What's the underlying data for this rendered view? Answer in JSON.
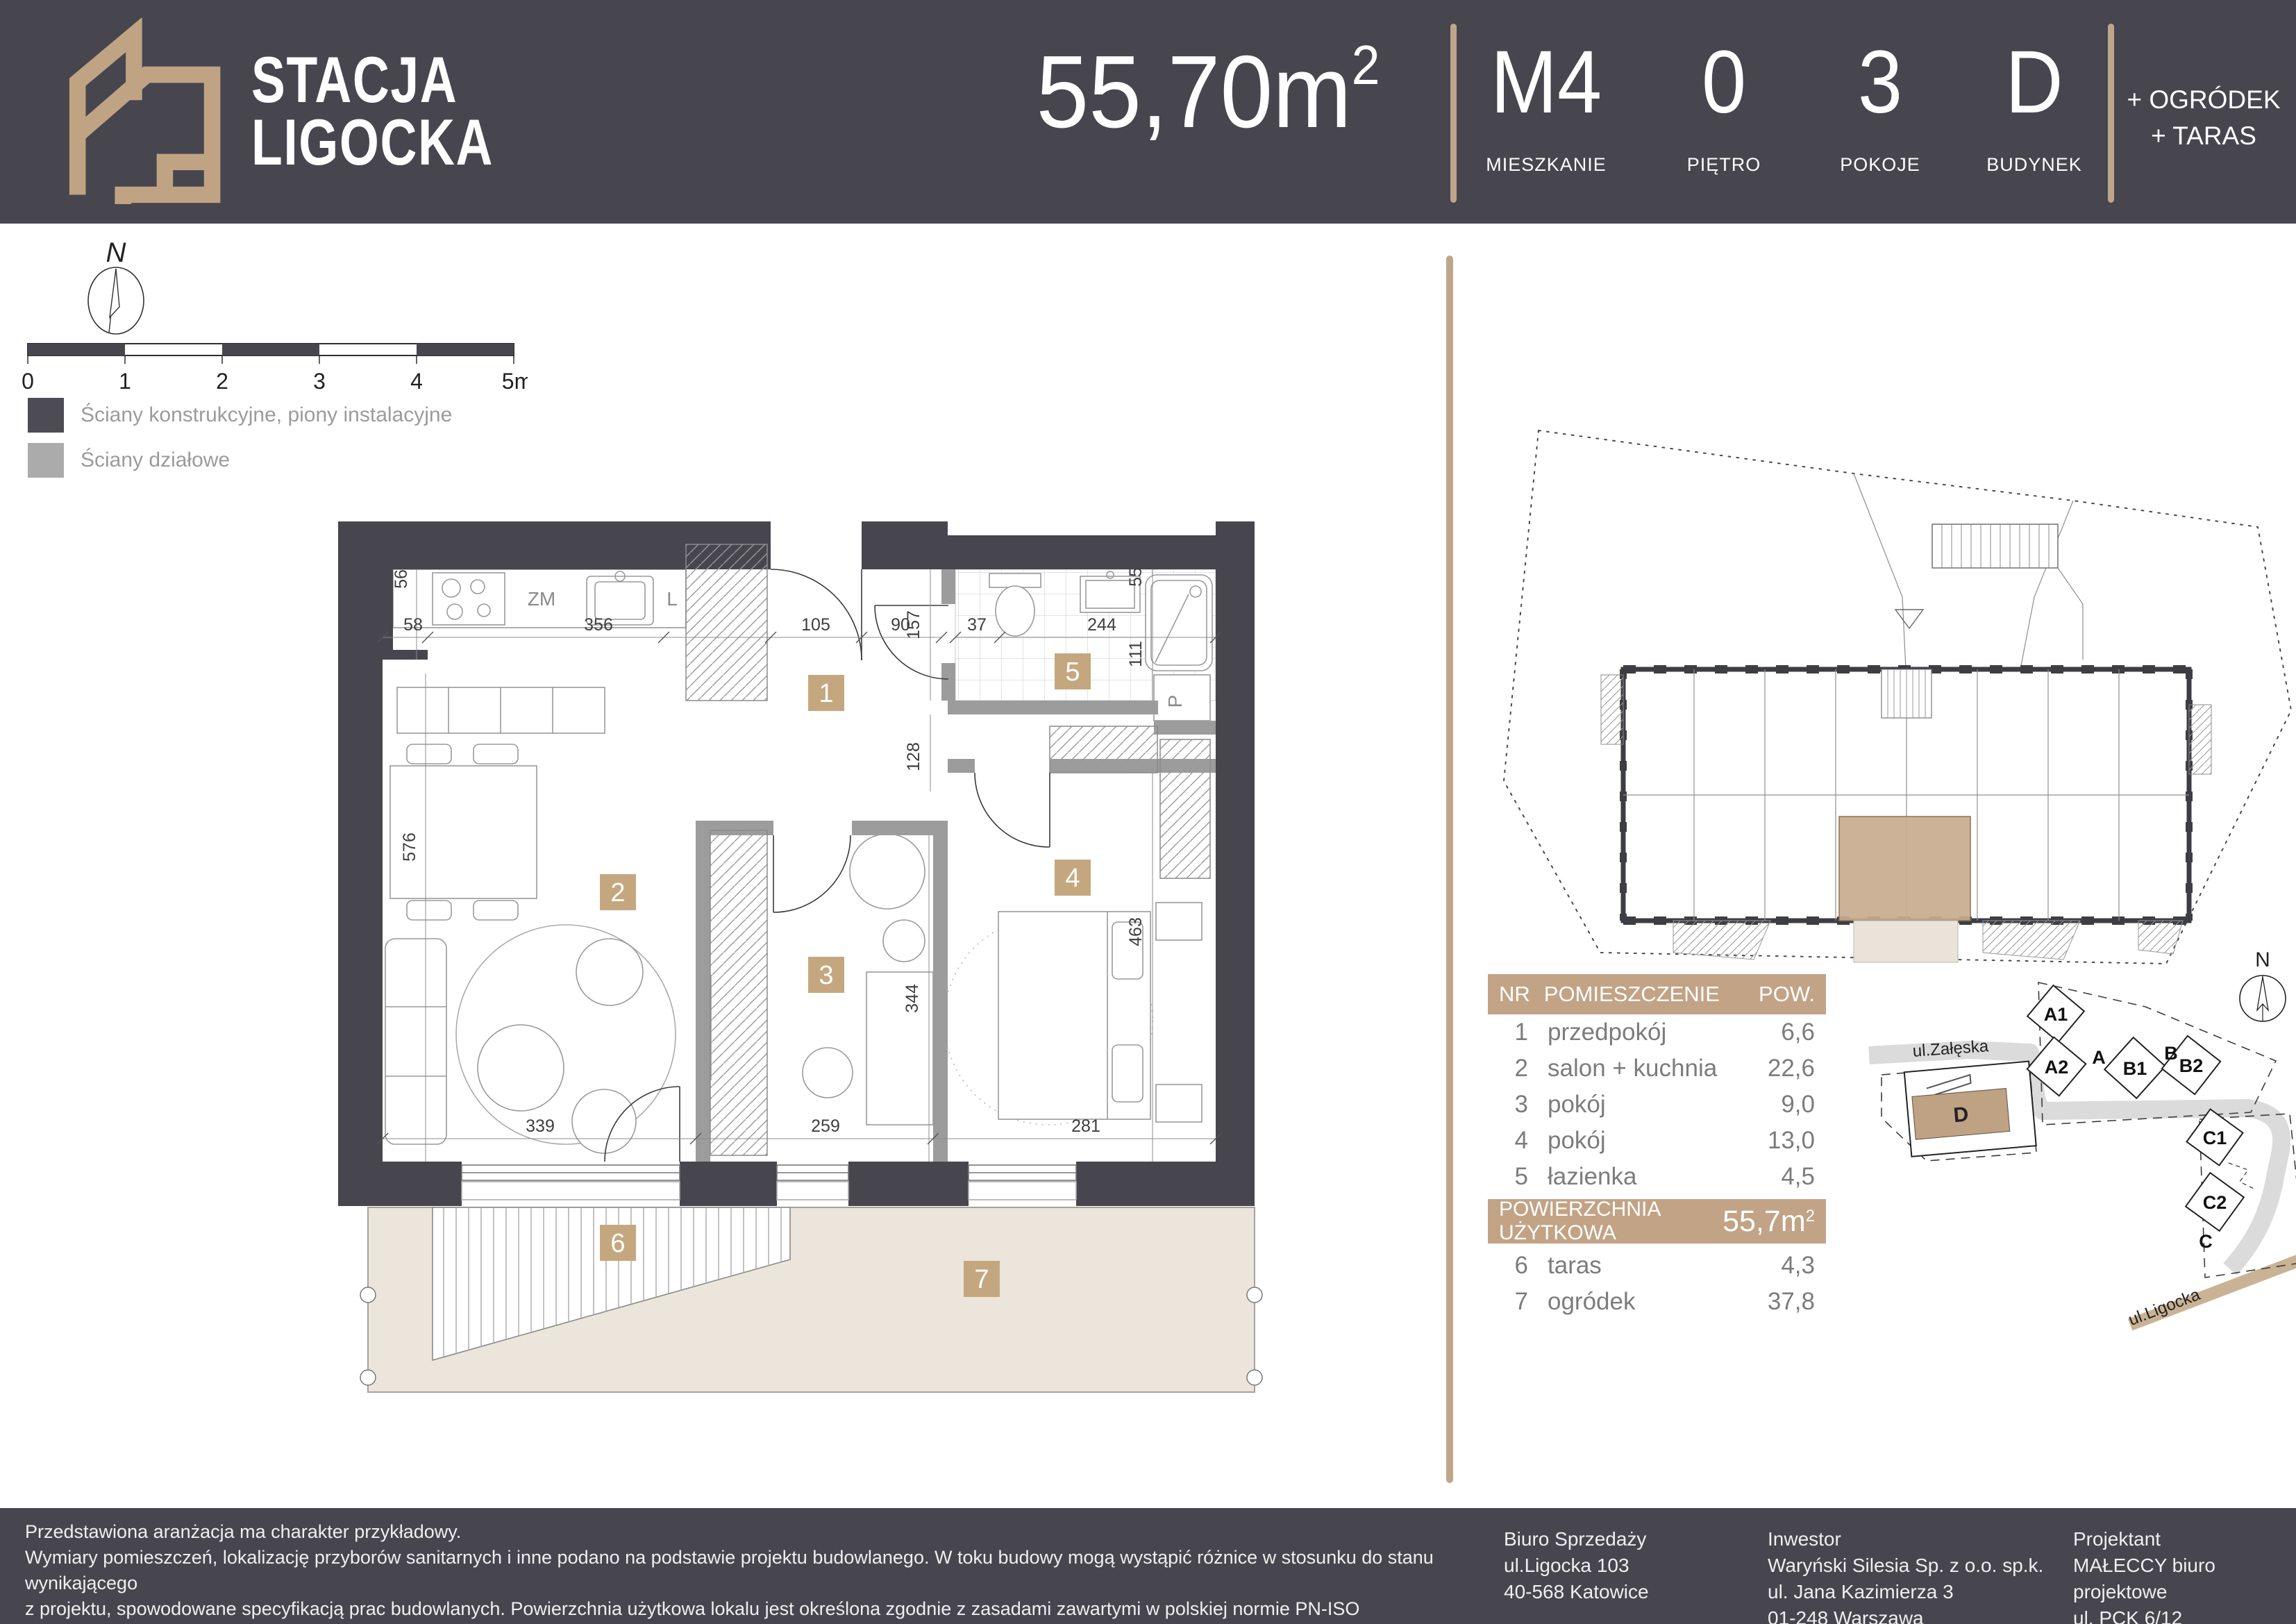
{
  "colors": {
    "dark": "#47454E",
    "accent_tan": "#BFA383",
    "badge_tan": "#C5A77F",
    "beige": "#EBE5DB",
    "partition_gray": "#9C9C9C",
    "highlight_unit": "#C8AD8E",
    "road_tan": "#C9B394"
  },
  "header": {
    "logo": {
      "line1": "STACJA",
      "line2": "LIGOCKA"
    },
    "area_value": "55,70m",
    "area_sup": "2",
    "stats": [
      {
        "value": "M4",
        "label": "MIESZKANIE"
      },
      {
        "value": "0",
        "label": "PIĘTRO"
      },
      {
        "value": "3",
        "label": "POKOJE"
      },
      {
        "value": "D",
        "label": "BUDYNEK"
      }
    ],
    "extra_line1": "+ OGRÓDEK",
    "extra_line2": "+ TARAS"
  },
  "legend": {
    "compass_n": "N",
    "scale_ticks": [
      "0",
      "1",
      "2",
      "3",
      "4",
      "5m"
    ],
    "items": [
      {
        "label": "Ściany konstrukcyjne, piony instalacyjne"
      },
      {
        "label": "Ściany działowe"
      }
    ]
  },
  "plan": {
    "badges": [
      "1",
      "2",
      "3",
      "4",
      "5",
      "6",
      "7"
    ],
    "dims": {
      "d56": "56",
      "d58": "58",
      "d356": "356",
      "d105": "105",
      "d90": "90",
      "d157": "157",
      "d37": "37",
      "d244": "244",
      "d55": "55",
      "d111": "111",
      "d128": "128",
      "d576": "576",
      "d344": "344",
      "d463": "463",
      "d339": "339",
      "d259": "259",
      "d281": "281"
    },
    "labels": {
      "zm": "ZM",
      "l": "L",
      "p": "P"
    }
  },
  "rooms_table": {
    "col_nr": "NR",
    "col_name": "POMIESZCZENIE",
    "col_area": "POW.",
    "rows": [
      {
        "nr": "1",
        "name": "przedpokój",
        "area": "6,6"
      },
      {
        "nr": "2",
        "name": "salon + kuchnia",
        "area": "22,6"
      },
      {
        "nr": "3",
        "name": "pokój",
        "area": "9,0"
      },
      {
        "nr": "4",
        "name": "pokój",
        "area": "13,0"
      },
      {
        "nr": "5",
        "name": "łazienka",
        "area": "4,5"
      }
    ],
    "total_label": "POWIERZCHNIA UŻYTKOWA",
    "total_value": "55,7m",
    "total_sup": "2",
    "outdoor_rows": [
      {
        "nr": "6",
        "name": "taras",
        "area": "4,3"
      },
      {
        "nr": "7",
        "name": "ogródek",
        "area": "37,8"
      }
    ]
  },
  "site_map": {
    "compass_n": "N",
    "streets": {
      "zaleska": "ul.Załęska",
      "ligocka": "ul.Ligocka"
    },
    "buildings": {
      "a1": "A1",
      "a": "A",
      "a2": "A2",
      "b": "B",
      "b1": "B1",
      "b2": "B2",
      "c1": "C1",
      "c2": "C2",
      "c": "C",
      "d": "D"
    }
  },
  "footer": {
    "disclaimer": [
      "Przedstawiona aranżacja ma charakter przykładowy.",
      "Wymiary pomieszczeń, lokalizację przyborów sanitarnych i inne podano na podstawie projektu budowlanego. W toku budowy mogą wystąpić różnice w stosunku do stanu wynikającego",
      "z projektu, spowodowane specyfikacją prac budowlanych. Powierzchnia użytkowa lokalu jest określona zgodnie z zasadami zawartymi w polskiej normie PN-ISO 9836:2022-07 i jest",
      "obliczona w świetle pionowych przegród w stanie wykończonym tynkiem. Do powierzchni użytkowej nie są wliczane powierzchnie przekroju poziomego ścianek działowych."
    ],
    "columns": [
      {
        "lines": [
          "Biuro Sprzedaży",
          "ul.Ligocka 103",
          "40-568 Katowice"
        ]
      },
      {
        "lines": [
          "Inwestor",
          "Waryński Silesia Sp. z o.o. sp.k.",
          "ul. Jana Kazimierza 3",
          "01-248 Warszawa"
        ]
      },
      {
        "lines": [
          "Projektant",
          "MAŁECCY biuro projektowe",
          "ul. PCK 6/12",
          "40-057 Katowice"
        ]
      }
    ]
  }
}
